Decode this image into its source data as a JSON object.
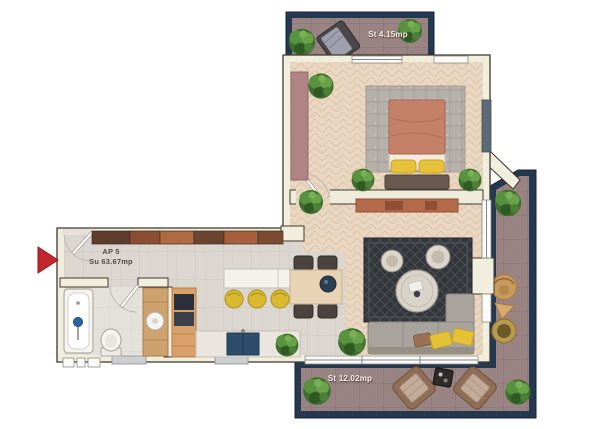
{
  "labels": {
    "apartment_id": "AP 5",
    "usable_area": "Su 63.67mp",
    "terrace_top_area": "St 4.15mp",
    "terrace_bottom_area": "St 12.02mp"
  },
  "colors": {
    "entrance_arrow": "#c1272d",
    "railing_navy": "#24384f",
    "terrace_tile": "#9a8383",
    "wall_cream": "#f1eedd",
    "wood_floor": "#e9d7c1",
    "tile_floor": "#dbd6d0",
    "rug_dark": "#33373c",
    "accent_yellow": "#e5c136",
    "bed_blanket": "#c58168",
    "sofa_gray": "#a8a49d",
    "wardrobe_brown": "#8a4f32",
    "plant_green": "#4c7a36"
  }
}
